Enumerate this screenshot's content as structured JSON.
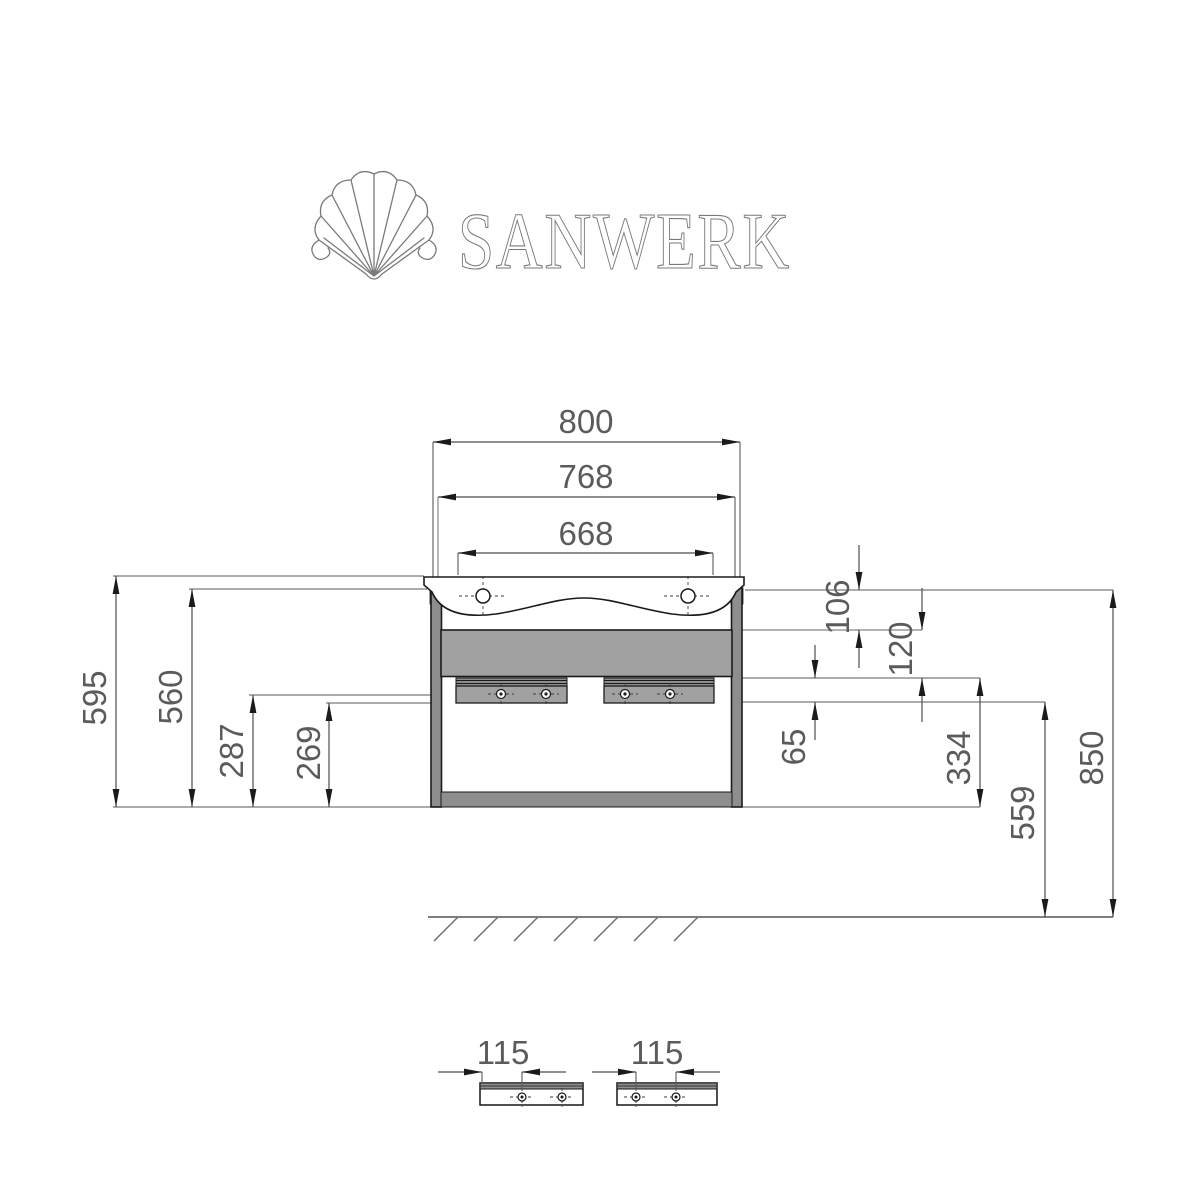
{
  "brand": {
    "name": "SANWERK",
    "logo_icon": "scallop-shell-icon"
  },
  "dims": {
    "d800": "800",
    "d768": "768",
    "d668": "668",
    "d595": "595",
    "d560": "560",
    "d287": "287",
    "d269": "269",
    "d106": "106",
    "d120": "120",
    "d65": "65",
    "d334": "334",
    "d559": "559",
    "d850": "850",
    "d115_left": "115",
    "d115_right": "115"
  }
}
